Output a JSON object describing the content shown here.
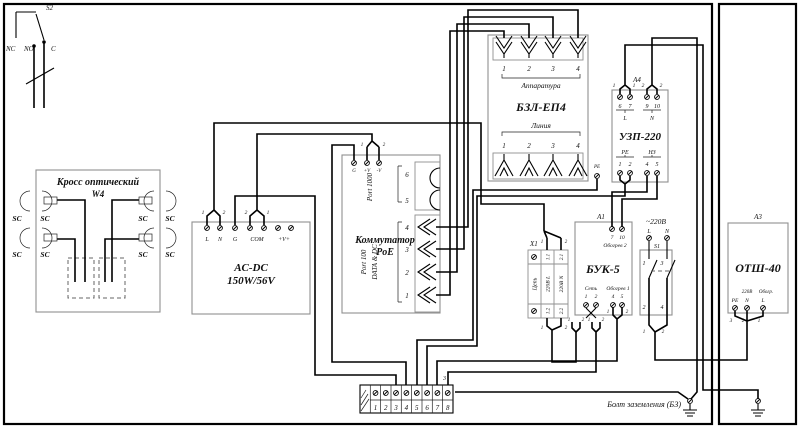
{
  "s2": {
    "designator": "S2",
    "nc": "NC",
    "no": "NO",
    "c": "C"
  },
  "w4": {
    "title": "Кросс оптический",
    "designator": "W4",
    "sc": "SC"
  },
  "acdc": {
    "title": "AC-DC",
    "power": "150W/56V",
    "t_l": "L",
    "t_n": "N",
    "t_g": "G",
    "t_com": "COM",
    "t_v": "+V+",
    "pin1": "1",
    "pin2": "2"
  },
  "poe": {
    "title1": "Коммутатор",
    "title2": "PoE",
    "t_g": "G",
    "t_vp": "+V",
    "t_vm": "-V",
    "pin1": "1",
    "pin2": "2",
    "port1000": {
      "label": "Port 1000",
      "p6": "6",
      "p5": "5"
    },
    "port100": {
      "label1": "Port 100",
      "label2": "DATA & DC",
      "p4": "4",
      "p3": "3",
      "p2": "2",
      "p1": "1"
    }
  },
  "bzl": {
    "title": "БЗЛ-ЕП4",
    "top": "Аппаратура",
    "bottom": "Линия",
    "n1": "1",
    "n2": "2",
    "n3": "3",
    "n4": "4",
    "pe": "PE"
  },
  "uzp": {
    "designator": "А4",
    "title": "УЗП-220",
    "pin1": "1",
    "pin2": "2",
    "t6": "6",
    "t7": "7",
    "t9": "9",
    "t10": "10",
    "l": "L",
    "n": "N",
    "pe": "PE",
    "nz": "НЗ",
    "b1": "1",
    "b2": "2",
    "b4": "4",
    "b5": "5"
  },
  "x1": {
    "designator": "X1",
    "header": "Цепь",
    "row1": {
      "label": "220В L",
      "a": "1.1",
      "b": "1.2"
    },
    "row2": {
      "label": "220В N",
      "a": "2.1",
      "b": "2.2"
    },
    "pin1": "1",
    "pin2": "2"
  },
  "buk": {
    "designator": "А1",
    "title": "БУК-5",
    "heat2": "Обогрев 2",
    "h2a": "7",
    "h2b": "10",
    "net": "Сеть",
    "na": "1",
    "nb": "2",
    "heat1": "Обогрев 1",
    "h1a": "4",
    "h1b": "5",
    "pin1": "1",
    "pin2": "2"
  },
  "s1": {
    "designator": "S1",
    "supply": "~220В",
    "l": "L",
    "n": "N",
    "c1": "1",
    "c2": "2",
    "c3": "3",
    "c4": "4",
    "pin1": "1",
    "pin2": "2"
  },
  "otsh": {
    "designator": "А3",
    "title": "ОТШ-40",
    "v": "220В",
    "heat": "Обогр.",
    "pe": "PE",
    "n": "N",
    "l": "L",
    "p3": "3",
    "p2": "2",
    "p1": "1"
  },
  "strip": {
    "t": [
      "1",
      "2",
      "3",
      "4",
      "5",
      "6",
      "7",
      "8"
    ],
    "wire3": "3"
  },
  "ground": {
    "bolt": "Болт заземления (БЗ)"
  }
}
